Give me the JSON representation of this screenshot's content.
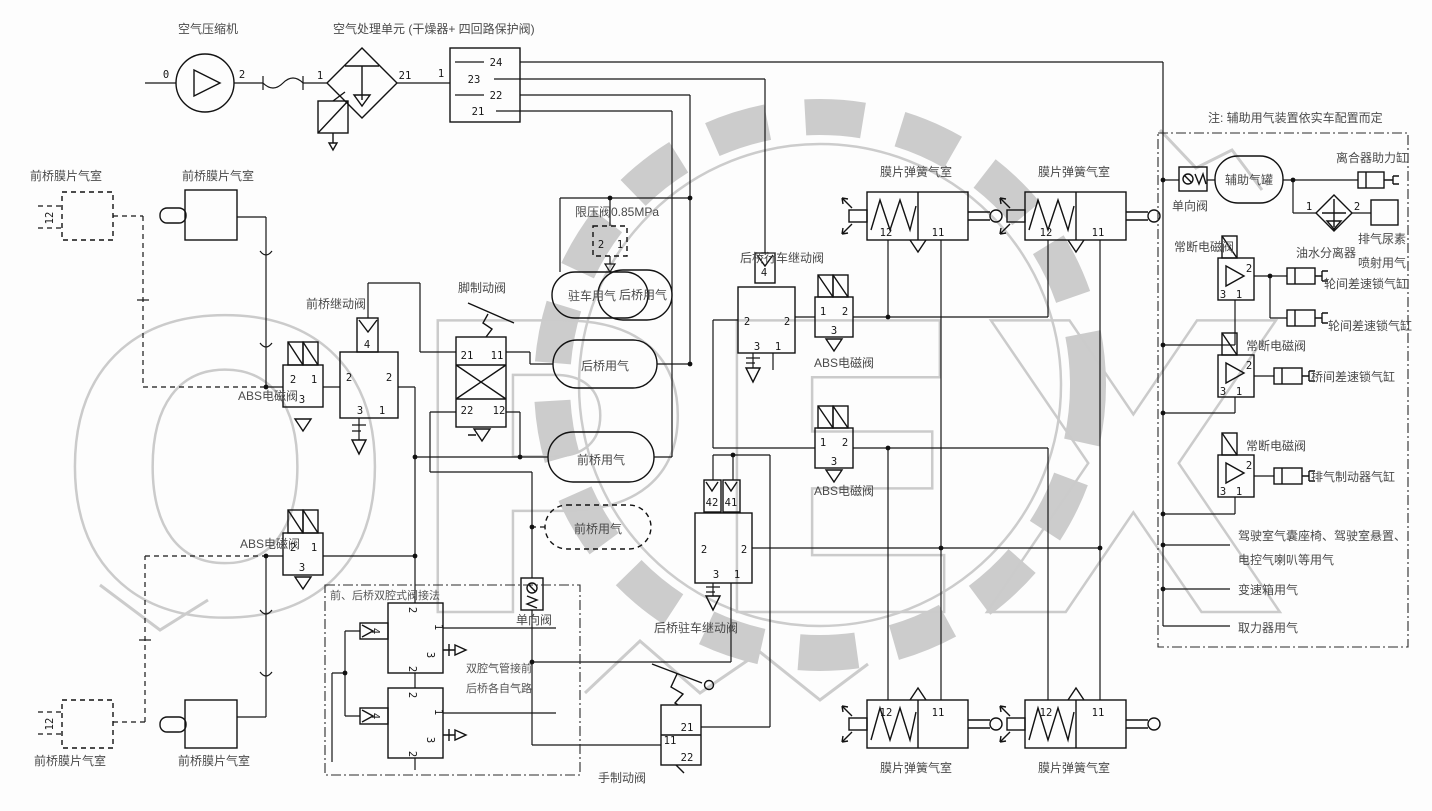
{
  "diagram": {
    "labels": {
      "compressor": "空气压缩机",
      "air_unit": "空气处理单元 (干燥器+ 四回路保护阀)",
      "front_chamber": "前桥膜片气室",
      "front_relay": "前桥继动阀",
      "abs_valve": "ABS电磁阀",
      "limit_valve": "限压阀0.85MPa",
      "foot_brake": "脚制动阀",
      "tank_parking": "驻车用气",
      "tank_rear": "后桥用气",
      "tank_front": "前桥用气",
      "check_valve": "单向阀",
      "rear_service_relay": "后桥行车继动阀",
      "rear_parking_relay": "后桥驻车继动阀",
      "hand_brake": "手制动阀",
      "spring_chamber": "膜片弹簧气室",
      "detail_header": "前、后桥双腔式阀接法",
      "detail_note1": "双腔气管接前",
      "detail_note2": "后桥各自气路"
    },
    "right_panel": {
      "note": "注: 辅助用气装置依实车配置而定",
      "check_valve": "单向阀",
      "aux_tank": "辅助气罐",
      "clutch": "离合器助力缸",
      "separator": "油水分离器",
      "urea1": "排气尿素",
      "urea2": "喷射用气",
      "solenoid": "常断电磁阀",
      "cyl_wheel": "轮间差速锁气缸",
      "cyl_axle": "桥间差速锁气缸",
      "cyl_exhaust": "排气制动器气缸",
      "cab1": "驾驶室气囊座椅、驾驶室悬置、",
      "cab2": "电控气喇叭等用气",
      "gearbox": "变速箱用气",
      "pto": "取力器用气"
    },
    "num": {
      "n0": "0",
      "n1": "1",
      "n2": "2",
      "n3": "3",
      "n4": "4",
      "n11": "11",
      "n12": "12",
      "n21": "21",
      "n22": "22",
      "n23": "23",
      "n24": "24",
      "n41": "41",
      "n42": "42"
    },
    "watermark": {
      "text": "OPEX",
      "color": "#cbcbcb"
    }
  }
}
